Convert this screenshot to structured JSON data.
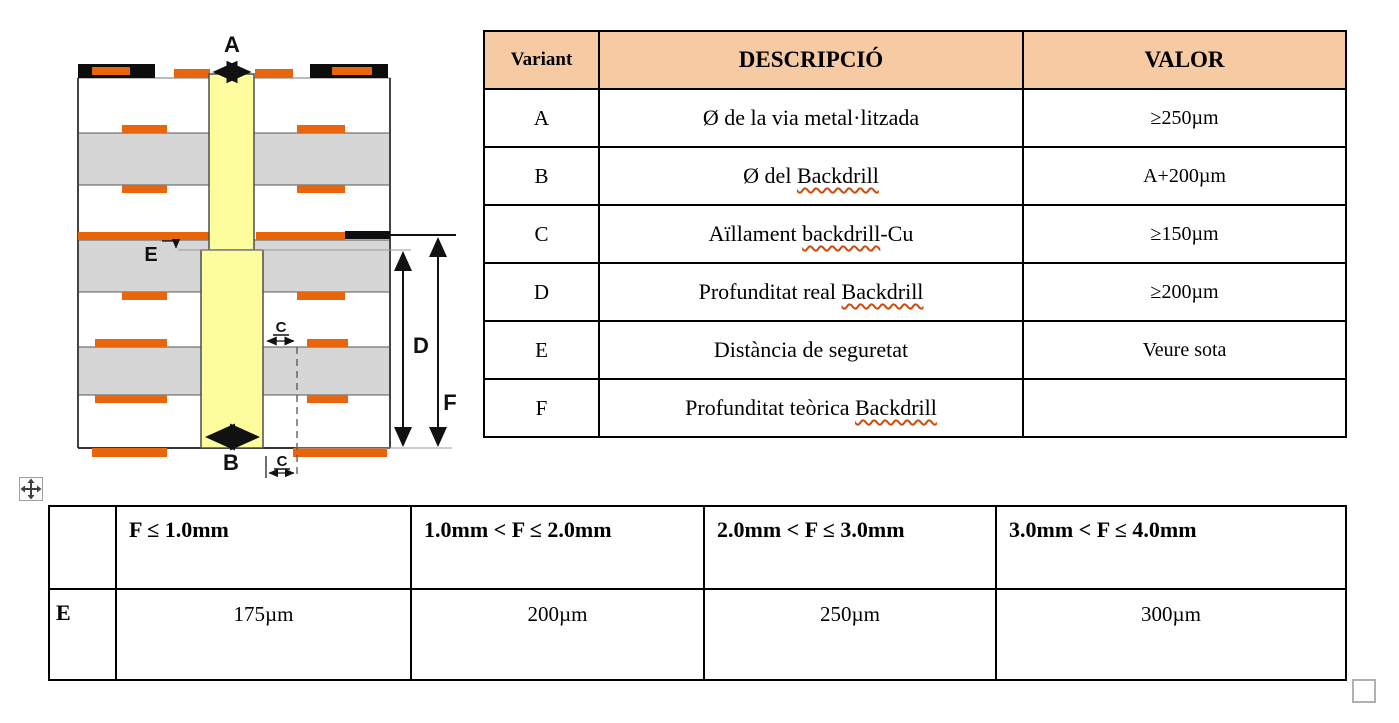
{
  "diagram": {
    "dim_labels": {
      "A": "A",
      "B": "B",
      "C_mid": "C",
      "C_bot": "C",
      "D": "D",
      "E": "E",
      "F": "F"
    },
    "colors": {
      "via_yellow": "#FDFD9D",
      "pad_orange": "#E8650C",
      "core_gray": "#D6D6D6",
      "copper_black": "#0d0d0d",
      "header_bg": "#F6CBA4"
    }
  },
  "spec_table": {
    "headers": {
      "variant": "Variant",
      "descripcio": "DESCRIPCIÓ",
      "valor": "VALOR"
    },
    "rows": [
      {
        "variant": "A",
        "descripcio": [
          {
            "t": "Ø de la via metal·litzada",
            "sq": false
          }
        ],
        "valor": "≥250µm"
      },
      {
        "variant": "B",
        "descripcio": [
          {
            "t": "Ø del ",
            "sq": false
          },
          {
            "t": "Backdrill",
            "sq": true
          }
        ],
        "valor": "A+200µm"
      },
      {
        "variant": "C",
        "descripcio": [
          {
            "t": "Aïllament ",
            "sq": false
          },
          {
            "t": "backdrill",
            "sq": true
          },
          {
            "t": "-Cu",
            "sq": false
          }
        ],
        "valor": "≥150µm"
      },
      {
        "variant": "D",
        "descripcio": [
          {
            "t": "Profunditat real ",
            "sq": false
          },
          {
            "t": "Backdrill",
            "sq": true
          }
        ],
        "valor": "≥200µm"
      },
      {
        "variant": "E",
        "descripcio": [
          {
            "t": "Distància de seguretat",
            "sq": false
          }
        ],
        "valor": "Veure sota"
      },
      {
        "variant": "F",
        "descripcio": [
          {
            "t": "Profunditat teòrica ",
            "sq": false
          },
          {
            "t": "Backdrill",
            "sq": true
          }
        ],
        "valor": ""
      }
    ]
  },
  "e_table": {
    "col_headers": [
      "",
      "F ≤ 1.0mm",
      "1.0mm < F ≤ 2.0mm",
      "2.0mm < F ≤ 3.0mm",
      "3.0mm < F ≤ 4.0mm"
    ],
    "row_label": "E",
    "values": [
      "175µm",
      "200µm",
      "250µm",
      "300µm"
    ]
  },
  "word_ui": {
    "move_handle_icon": "move-cross-icon",
    "resize_handle_icon": "resize-square-icon"
  }
}
